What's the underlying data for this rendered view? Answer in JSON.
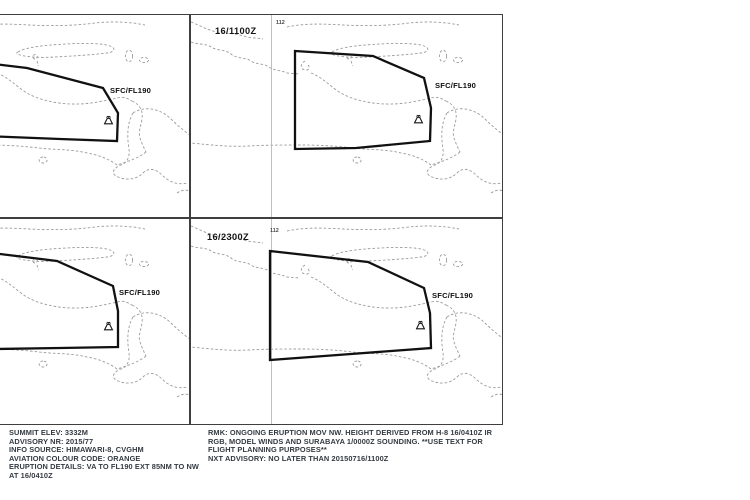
{
  "graphic": {
    "type": "volcanic-ash-advisory-4panel-forecast",
    "meridian_label": "112",
    "flight_level_label": "SFC/FL190"
  },
  "panels": [
    {
      "name": "forecast-panel-top-left",
      "time_label": "",
      "fl_label": "SFC/FL190",
      "points": "58,42 150,53 226,73 241,98 240,126 183,124 58,119",
      "volcano_transform": "translate(227,101)"
    },
    {
      "name": "forecast-panel-top-right",
      "time_label": "16/1100Z",
      "fl_label": "SFC/FL190",
      "points": "104,36 182,41 233,63 240,93 239,126 165,133 104,134",
      "volcano_transform": "translate(223,100)"
    },
    {
      "name": "forecast-panel-bottom-left",
      "time_label": "",
      "fl_label": "SFC/FL190",
      "points": "58,27 180,42 236,67 241,92 241,128 183,129 58,131",
      "volcano_transform": "translate(227,103)"
    },
    {
      "name": "forecast-panel-bottom-right",
      "time_label": "16/2300Z",
      "fl_label": "SFC/FL190",
      "points": "79,32 177,43 233,69 239,94 240,129 160,135 79,141",
      "volcano_transform": "translate(225,102)"
    }
  ],
  "footer": {
    "left_lines": [
      "SUMMIT ELEV: 3332M",
      "ADVISORY NR: 2015/77",
      "INFO SOURCE: HIMAWARI-8, CVGHM",
      "AVIATION COLOUR CODE: ORANGE",
      "ERUPTION DETAILS: VA TO FL190 EXT 85NM TO NW",
      "AT 16/0410Z"
    ],
    "right_lines": [
      "RMK: ONGOING ERUPTION MOV NW. HEIGHT DERIVED FROM H-8 16/0410Z IR",
      "RGB, MODEL WINDS AND SURABAYA 1/0000Z SOUNDING. **USE TEXT FOR",
      "FLIGHT PLANNING PURPOSES**",
      "NXT ADVISORY: NO LATER THAN 20150716/1100Z"
    ]
  },
  "colors": {
    "background": "#ffffff",
    "ash_polygon_outline": "#111111",
    "coastline": "#9c9c9c",
    "panel_border": "#3f3f3f",
    "footer_text": "#333a41"
  }
}
